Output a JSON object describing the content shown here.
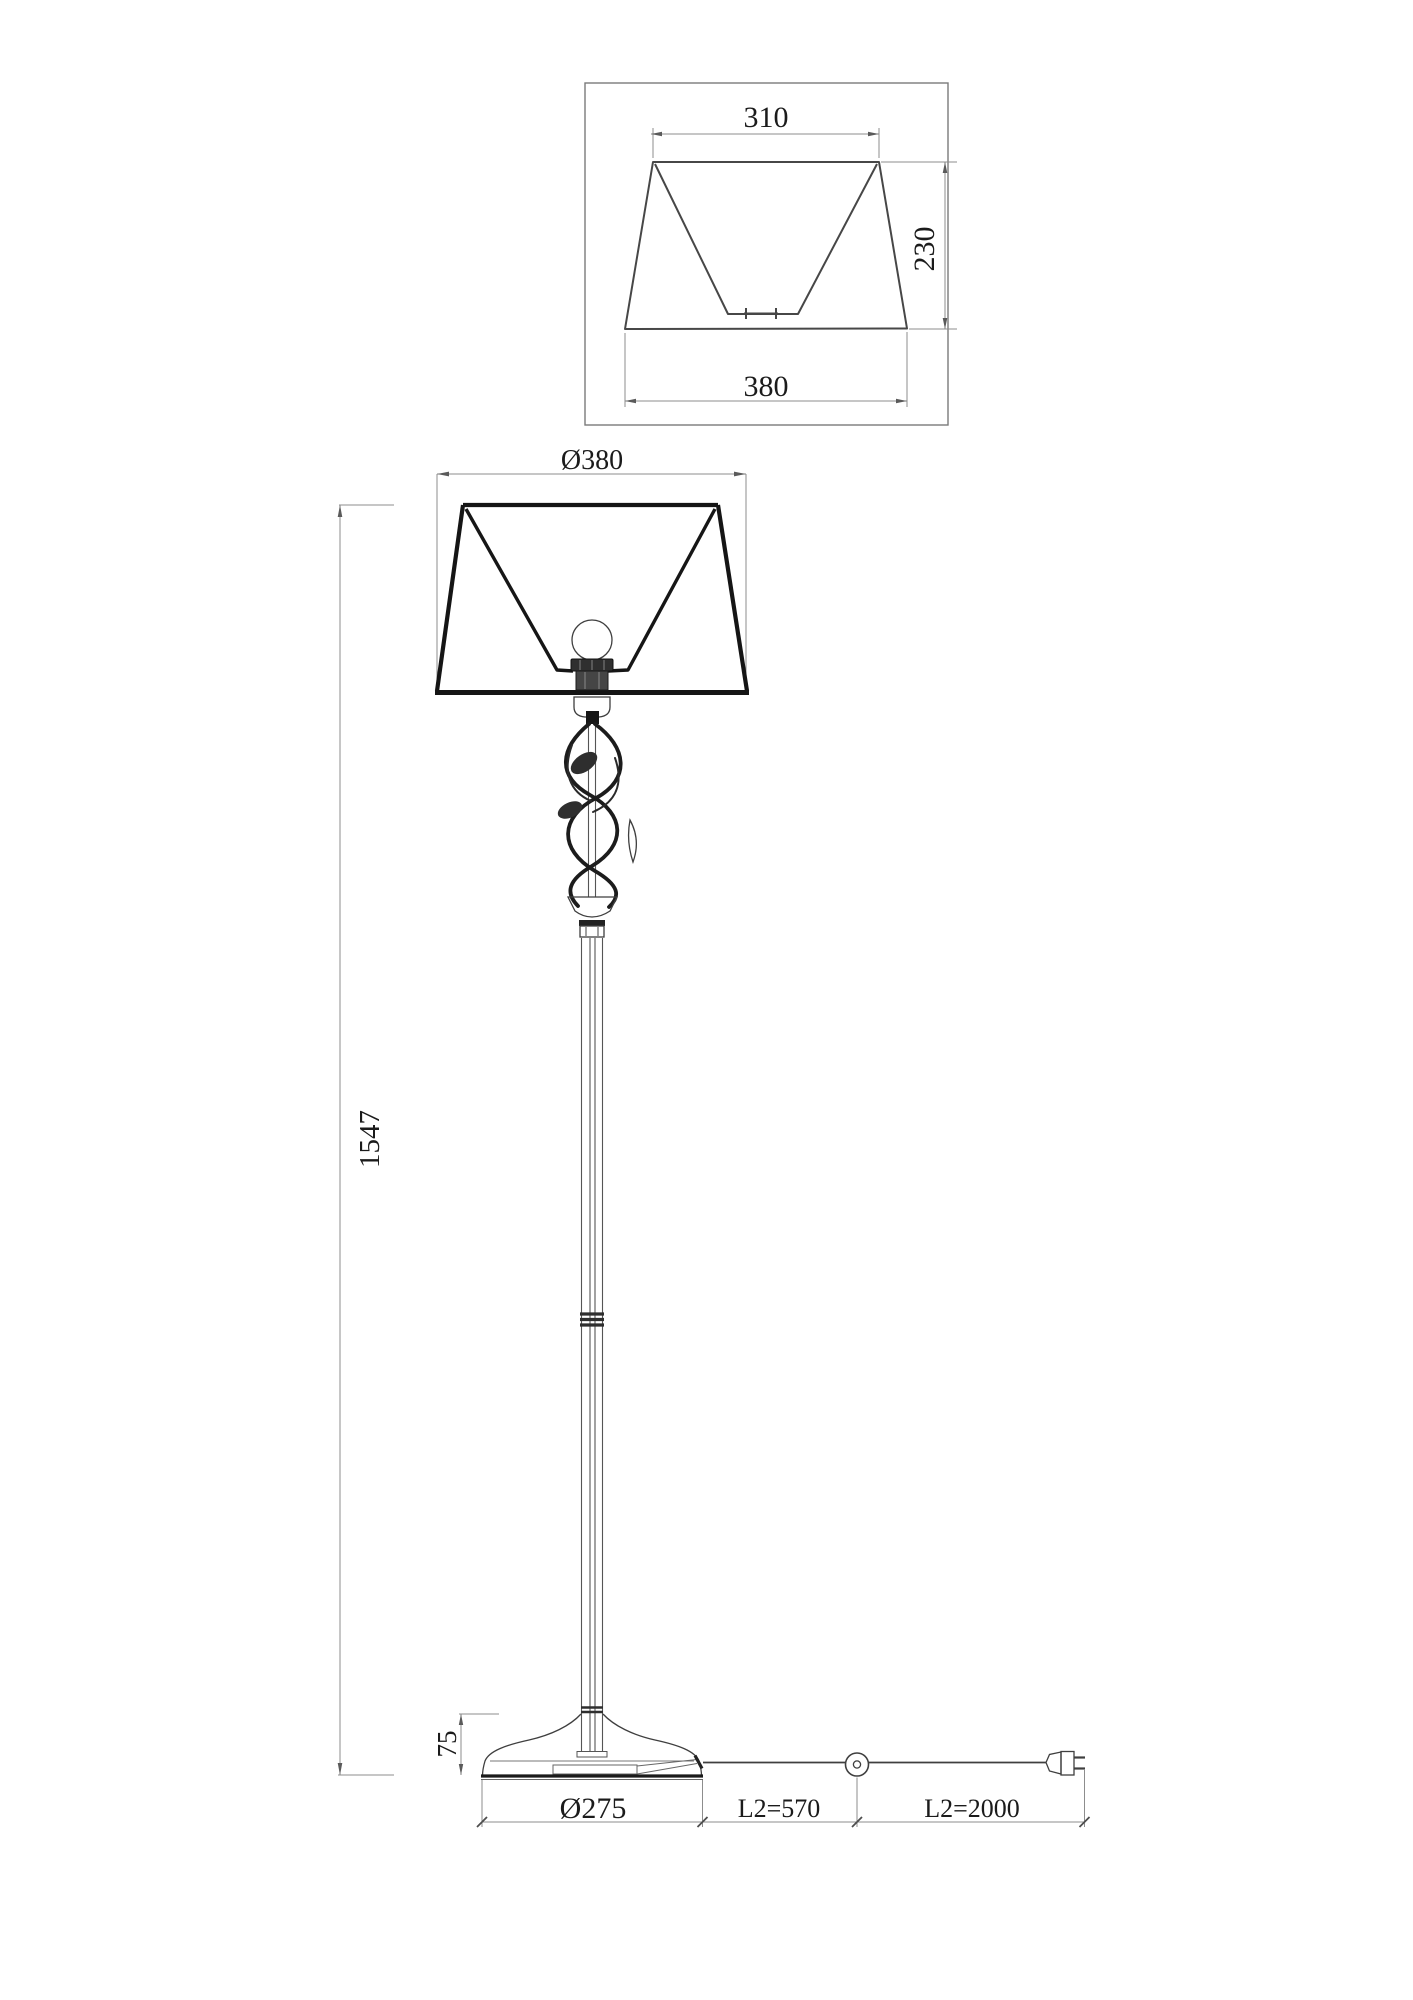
{
  "page": {
    "background": "#ffffff",
    "line_color": "#3f3f3f",
    "dimension_line_color": "#8d8d8d",
    "text_color": "#1b1b1b"
  },
  "detail_view": {
    "description": "lamp shade cross-section detail",
    "top_width": "310",
    "height": "230",
    "bottom_width": "380"
  },
  "main_view": {
    "description": "floor lamp front elevation",
    "shade_diameter": "Ø380",
    "total_height": "1547",
    "base_height": "75",
    "base_diameter": "Ø275",
    "cord_to_switch": "L2=570",
    "cord_to_plug": "L2=2000"
  }
}
